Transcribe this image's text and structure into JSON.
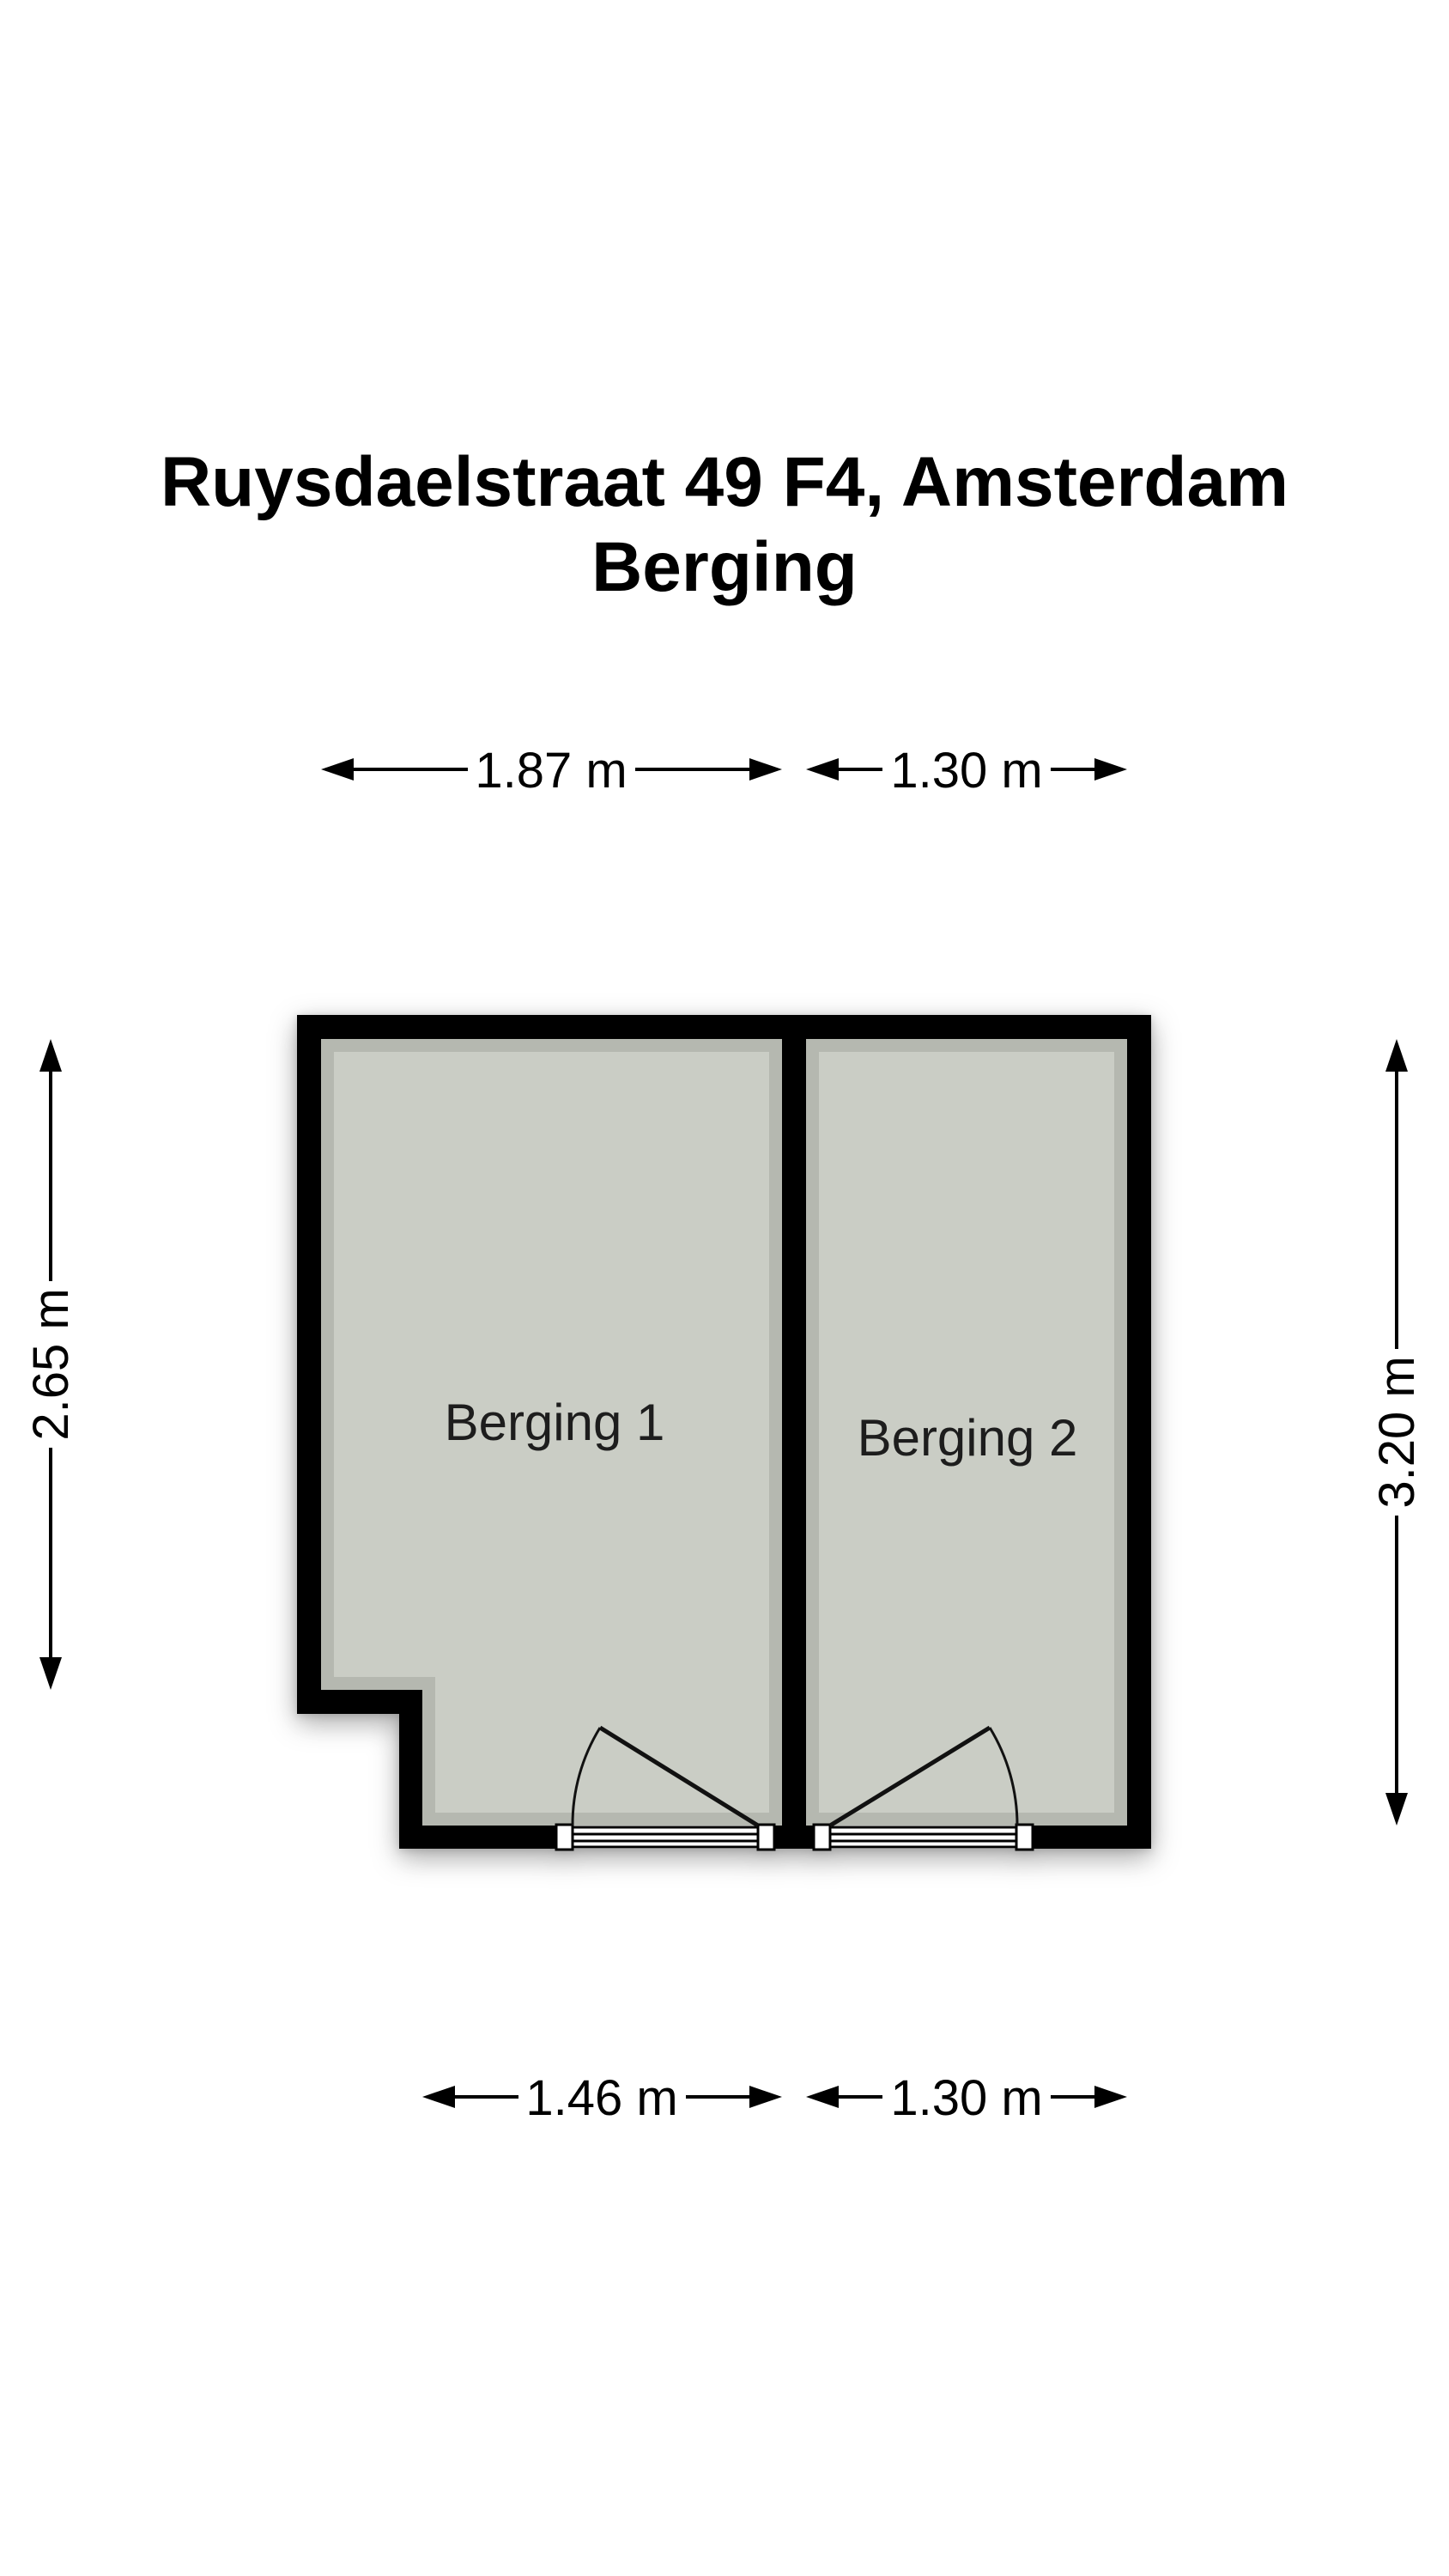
{
  "title": {
    "address": "Ruysdaelstraat 49 F4, Amsterdam",
    "subtitle": "Berging"
  },
  "rooms": [
    {
      "label": "Berging 1"
    },
    {
      "label": "Berging 2"
    }
  ],
  "dimensions": {
    "top_left_width": "1.87 m",
    "top_right_width": "1.30 m",
    "left_height": "2.65 m",
    "right_height": "3.20 m",
    "bottom_left_width": "1.46 m",
    "bottom_right_width": "1.30 m"
  },
  "colors": {
    "wall": "#000000",
    "floor": "#cacdc5",
    "background": "#ffffff",
    "dimension_text": "#000000",
    "label_text": "#1d1d1d"
  }
}
